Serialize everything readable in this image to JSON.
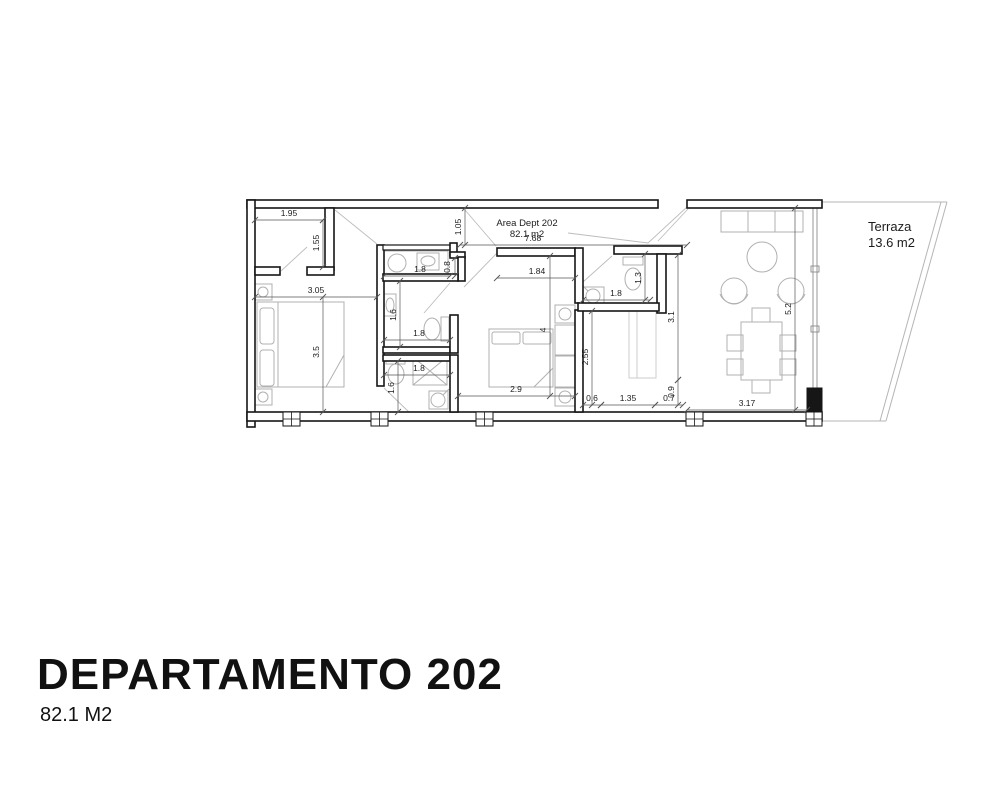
{
  "title_block": {
    "title": "DEPARTAMENTO 202",
    "subtitle": "82.1 M2"
  },
  "plan": {
    "area_label": "Area Dept 202",
    "area_value": "82.1 m2",
    "terrace_label": "Terraza",
    "terrace_value": "13.6 m2",
    "dims": {
      "closet_width": "1.95",
      "closet_depth": "1.55",
      "bedroom1_width": "3.05",
      "bedroom1_depth": "3.5",
      "corridor_width": "1.05",
      "laundry_depth": "0.8",
      "laundry_width": "1.8",
      "bath1_depth": "1.6",
      "bath1_width": "1.8",
      "bath2_width": "1.8",
      "bath2_depth": "1.6",
      "bedroom2_bottom_width": "2.9",
      "total_width": "7.68",
      "bedroom2_top_width": "1.84",
      "bedroom2_depth": "4",
      "kitchen_depth": "2.55",
      "hall_seg_a": "0.6",
      "hall_seg_b": "1.35",
      "hall_seg_c": "0.7",
      "counter_depth": "0.9",
      "bath3_depth": "1.3",
      "bath3_width": "1.8",
      "hall_depth": "3.1",
      "living_width": "3.17",
      "terrace_depth": "5.2"
    }
  }
}
